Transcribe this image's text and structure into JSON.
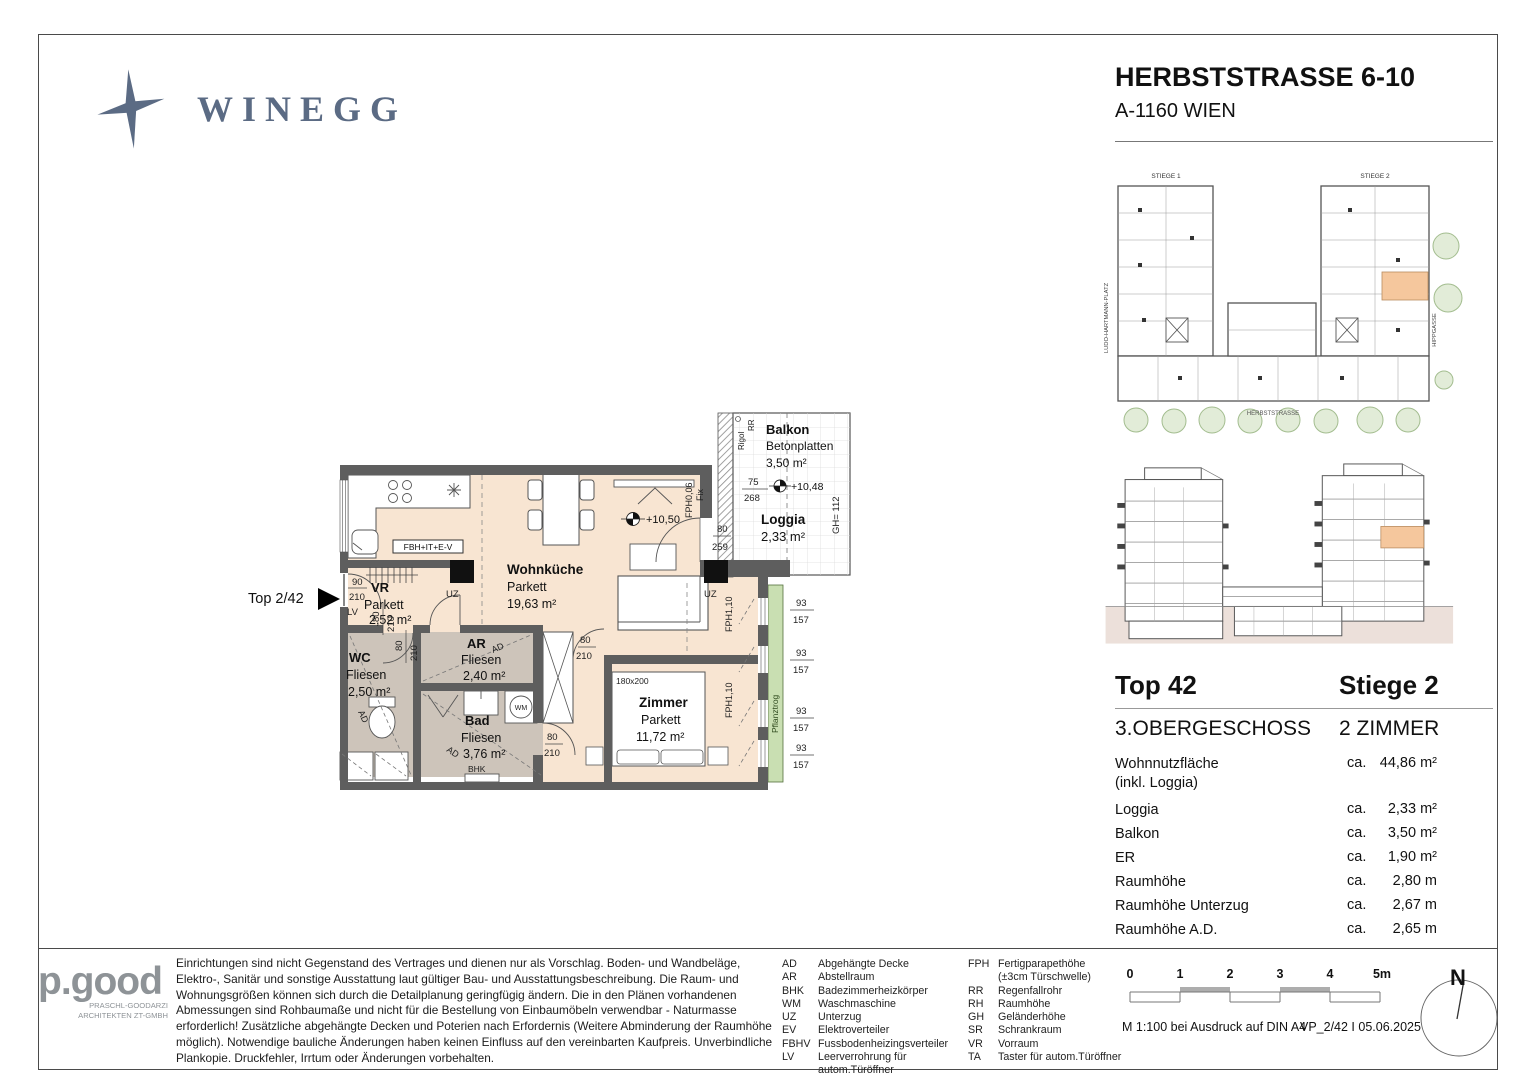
{
  "header": {
    "brand": "WINEGG",
    "title": "HERBSTSTRASSE 6-10",
    "subtitle": "A-1160 WIEN"
  },
  "site_plan": {
    "stiege1": "STIEGE 1",
    "stiege2": "STIEGE 2",
    "street_left": "LUDO-HARTMANN-PLATZ",
    "street_right": "HIPPGASSE",
    "street_bottom": "HERBSTSTRASSE"
  },
  "floor_plan": {
    "unit_marker": "Top 2/42",
    "rooms": {
      "wohnkueche": {
        "name": "Wohnküche",
        "floor": "Parkett",
        "area": "19,63 m²"
      },
      "vr": {
        "name": "VR",
        "floor": "Parkett",
        "area": "2,52 m²"
      },
      "wc": {
        "name": "WC",
        "floor": "Fliesen",
        "area": "2,50 m²"
      },
      "ar": {
        "name": "AR",
        "floor": "Fliesen",
        "area": "2,40 m²"
      },
      "bad": {
        "name": "Bad",
        "floor": "Fliesen",
        "area": "3,76 m²"
      },
      "zimmer": {
        "name": "Zimmer",
        "floor": "Parkett",
        "area": "11,72 m²"
      },
      "balkon": {
        "name": "Balkon",
        "floor": "Betonplatten",
        "area": "3,50 m²"
      },
      "loggia": {
        "name": "Loggia",
        "area": "2,33 m²"
      }
    },
    "annotations": {
      "fbh": "FBH+IT+E-V",
      "uz": "UZ",
      "lv": "LV",
      "ad": "AD",
      "bhk": "BHK",
      "wm": "WM",
      "fix": "Fix",
      "fph006": "FPH0,06",
      "fph110": "FPH1,10",
      "gh": "GH= 112",
      "rigol": "Rigol",
      "rr": "RR",
      "pflanztrog": "Pflanztrog",
      "bed": "180x200",
      "elev_in": "+10,50",
      "elev_balk": "+10,48"
    },
    "dims": {
      "entry_w": "90",
      "entry_h": "210",
      "door_w": "80",
      "door_h": "210",
      "loggia_w": "80",
      "loggia_h": "259",
      "balk_w": "75",
      "balk_h": "268",
      "win_w": "93",
      "win_h": "157"
    },
    "colors": {
      "floor_peach": "#f8e5d2",
      "floor_gray": "#cdc4ba",
      "wall": "#5e5e5e",
      "plant_green": "#c9dfb2",
      "highlight": "#f5c79d"
    }
  },
  "details": {
    "top": "Top 42",
    "stiege": "Stiege 2",
    "floor": "3.OBERGESCHOSS",
    "rooms": "2 ZIMMER",
    "rows": [
      {
        "label": "Wohnnutzfläche",
        "label2": "(inkl. Loggia)",
        "prefix": "ca.",
        "value": "44,86 m²"
      },
      {
        "label": "Loggia",
        "prefix": "ca.",
        "value": "2,33 m²"
      },
      {
        "label": "Balkon",
        "prefix": "ca.",
        "value": "3,50 m²"
      },
      {
        "label": "ER",
        "prefix": "ca.",
        "value": "1,90 m²"
      },
      {
        "label": "Raumhöhe",
        "prefix": "ca.",
        "value": "2,80 m"
      },
      {
        "label": "Raumhöhe Unterzug",
        "prefix": "ca.",
        "value": "2,67 m"
      },
      {
        "label": "Raumhöhe A.D.",
        "prefix": "ca.",
        "value": "2,65 m"
      }
    ]
  },
  "footer": {
    "architect": {
      "logo": "p.good",
      "sub1": "PRASCHL-GOODARZI",
      "sub2": "ARCHITEKTEN ZT-GMBH"
    },
    "disclaimer": "Einrichtungen sind nicht Gegenstand des Vertrages und dienen nur als Vorschlag. Boden- und Wandbeläge, Elektro-, Sanitär und sonstige Ausstattung laut gültiger Bau- und Ausstattungsbeschreibung. Die Raum- und Wohnungsgrößen können sich durch die Detailplanung geringfügig ändern. Die in den Plänen vorhandenen Abmessungen sind Rohbaumaße und nicht für die Bestellung von Einbaumöbeln verwendbar - Naturmasse erforderlich! Zusätzliche abgehängte Decken und Poterien nach Erfordernis (Weitere Abminderung der Raumhöhe möglich). Notwendige bauliche Änderungen haben keinen Einfluss auf den vereinbarten Kaufpreis. Unverbindliche Plankopie. Druckfehler, Irrtum oder Änderungen vorbehalten.",
    "legend_left": [
      {
        "abbr": "AD",
        "term": "Abgehängte Decke"
      },
      {
        "abbr": "AR",
        "term": "Abstellraum"
      },
      {
        "abbr": "BHK",
        "term": "Badezimmerheizkörper"
      },
      {
        "abbr": "WM",
        "term": "Waschmaschine"
      },
      {
        "abbr": "UZ",
        "term": "Unterzug"
      },
      {
        "abbr": "EV",
        "term": "Elektroverteiler"
      },
      {
        "abbr": "FBHV",
        "term": "Fussbodenheizingsverteiler"
      },
      {
        "abbr": "LV",
        "term": "Leerverrohrung für autom.Türöffner"
      }
    ],
    "legend_right": [
      {
        "abbr": "FPH",
        "term": "Fertigparapethöhe"
      },
      {
        "abbr": "",
        "term": "(±3cm Türschwelle)"
      },
      {
        "abbr": "RR",
        "term": "Regenfallrohr"
      },
      {
        "abbr": "RH",
        "term": "Raumhöhe"
      },
      {
        "abbr": "GH",
        "term": "Geländerhöhe"
      },
      {
        "abbr": "SR",
        "term": "Schrankraum"
      },
      {
        "abbr": "VR",
        "term": "Vorraum"
      },
      {
        "abbr": "TA",
        "term": "Taster für autom.Türöffner"
      }
    ],
    "scale": {
      "ticks": [
        "0",
        "1",
        "2",
        "3",
        "4",
        "5m"
      ],
      "note": "M 1:100 bei Ausdruck auf DIN A4",
      "version": "VP_2/42 I 05.06.2025"
    },
    "north": "N"
  }
}
